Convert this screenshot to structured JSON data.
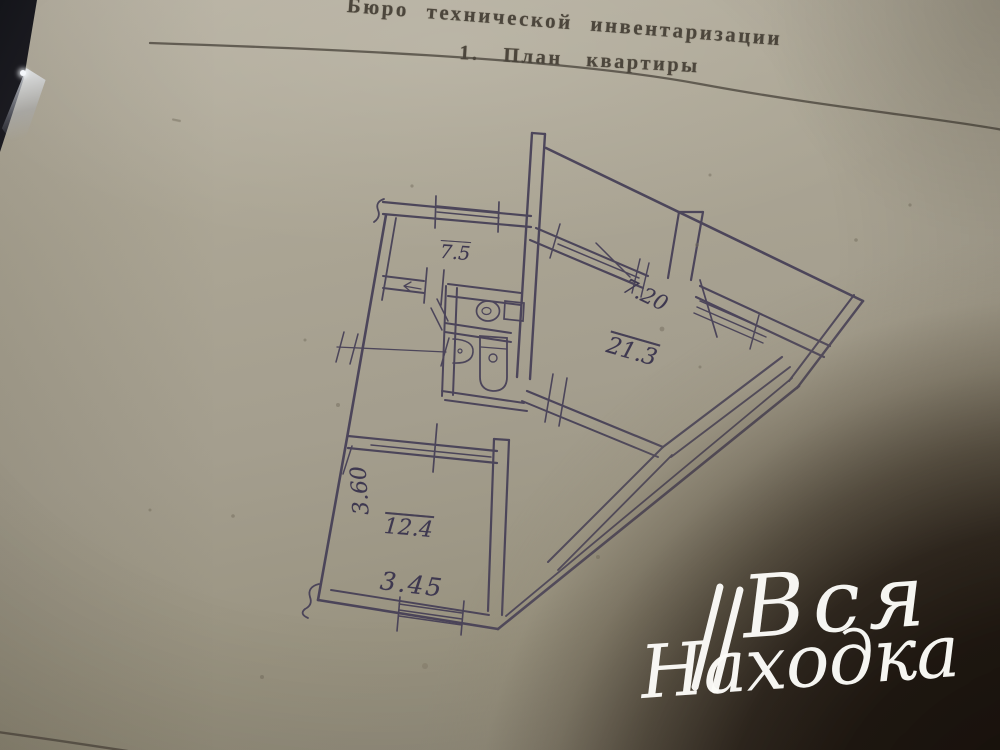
{
  "document": {
    "header": "Бюро технической инвентаризации",
    "section_title": "1. План квартиры"
  },
  "floor_plan": {
    "room_areas": {
      "upper_left_room": "7.5",
      "corridor": "7.20",
      "large_room": "21.3",
      "lower_room": "12.4"
    },
    "dimensions": {
      "lower_room_width": "3.60",
      "lower_room_length": "3.45"
    },
    "fixture_icons": [
      "toilet-icon",
      "sink-icon",
      "bathtub-icon"
    ]
  },
  "watermark": {
    "line1": "Вся",
    "line2": "Находка"
  },
  "colors": {
    "paper": "#a9a393",
    "plan_ink": "#443e56",
    "header_ink": "#4c463c",
    "shadow_core": "#170f08",
    "watermark_text": "#fcfcf9"
  }
}
